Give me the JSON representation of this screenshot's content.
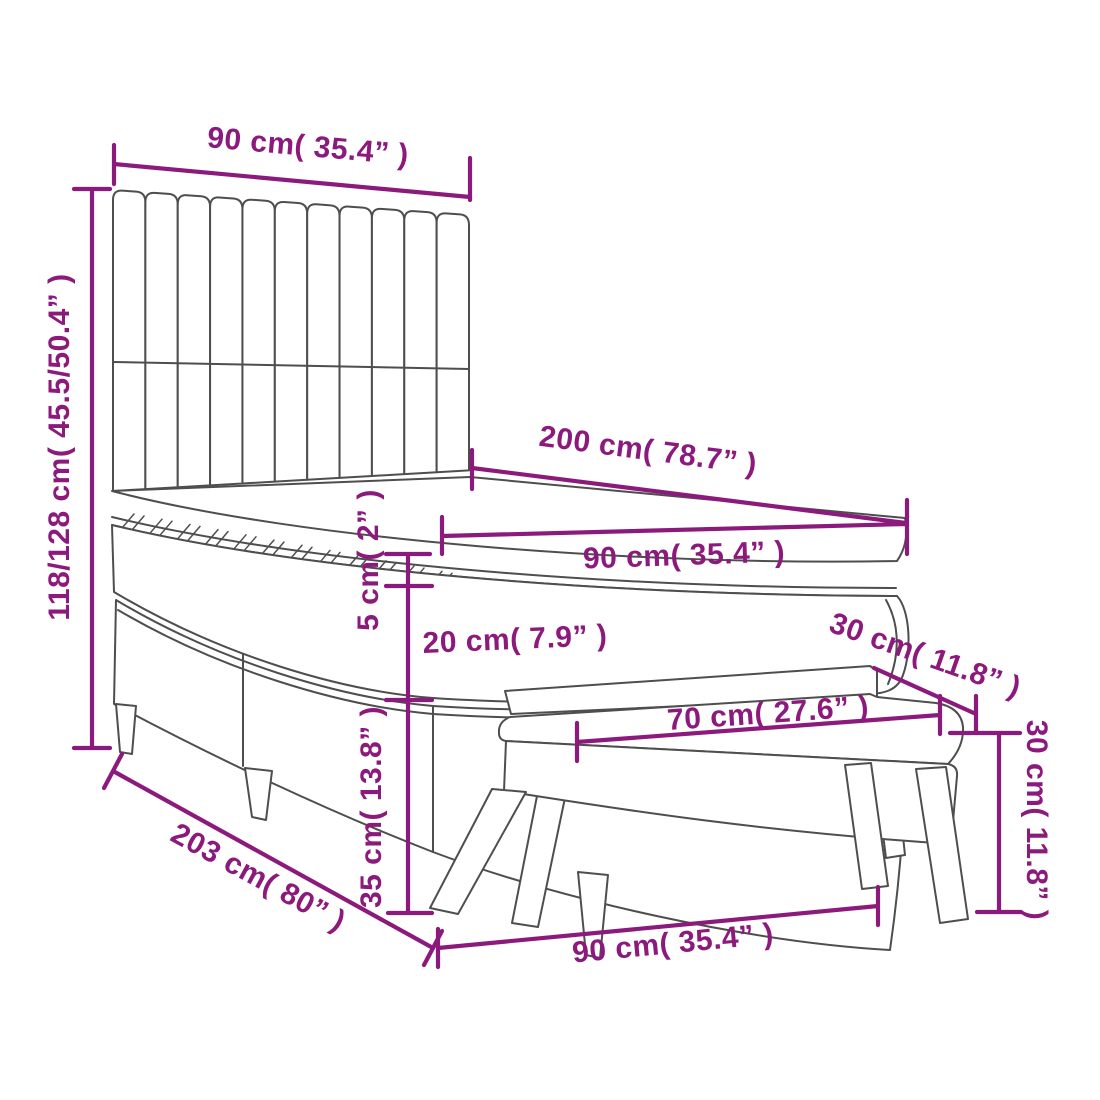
{
  "diagram": {
    "type": "furniture-dimension-diagram",
    "product": "Box spring bed with headboard, mattress topper, mattress, base and bench",
    "background_color": "#ffffff",
    "line_color": "#4e4e4e",
    "dimension_color": "#8c1a7c",
    "parts": [
      "headboard",
      "mattress-topper",
      "mattress",
      "box-spring-base",
      "bed-legs",
      "bench"
    ]
  },
  "dimensions": {
    "headboard_width": {
      "label": "90 cm( 35.4” )",
      "cm": "90",
      "inch": "35.4"
    },
    "bed_height": {
      "label": "118/128 cm( 45.5/50.4” )",
      "cm": "118/128",
      "inch": "45.5/50.4"
    },
    "bed_length": {
      "label": "200 cm( 78.7” )",
      "cm": "200",
      "inch": "78.7"
    },
    "mattress_width": {
      "label": "90 cm( 35.4” )",
      "cm": "90",
      "inch": "35.4"
    },
    "topper_thickness": {
      "label": "5 cm( 2” )",
      "cm": "5",
      "inch": "2"
    },
    "mattress_thickness": {
      "label": "20 cm( 7.9” )",
      "cm": "20",
      "inch": "7.9"
    },
    "base_height": {
      "label": "35 cm( 13.8” )",
      "cm": "35",
      "inch": "13.8"
    },
    "total_length": {
      "label": "203 cm( 80” )",
      "cm": "203",
      "inch": "80"
    },
    "base_width": {
      "label": "90 cm( 35.4” )",
      "cm": "90",
      "inch": "35.4"
    },
    "bench_length": {
      "label": "70 cm( 27.6” )",
      "cm": "70",
      "inch": "27.6"
    },
    "bench_depth": {
      "label": "30 cm( 11.8” )",
      "cm": "30",
      "inch": "11.8"
    },
    "bench_height": {
      "label": "30 cm( 11.8” )",
      "cm": "30",
      "inch": "11.8"
    }
  }
}
